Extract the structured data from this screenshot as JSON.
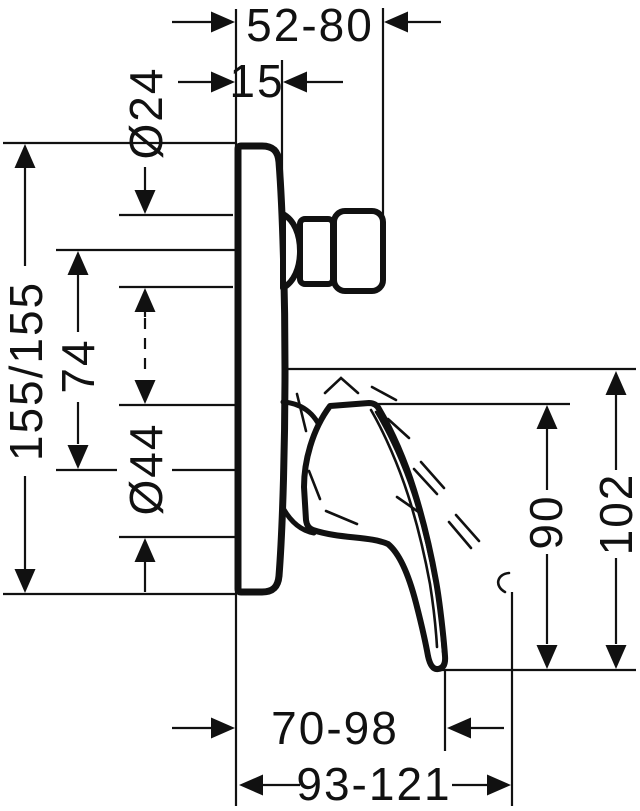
{
  "diagram": {
    "kind": "technical-dimension-drawing",
    "dimensions": {
      "knob_projection_range": "52-80",
      "plate_thickness": "15",
      "knob_diameter": "Ø24",
      "plate_height": "155/155",
      "knob_to_lever_distance": "74",
      "lever_hub_diameter": "Ø44",
      "lever_length": "90",
      "lever_overall_length": "102",
      "lever_tip_projection_range": "70-98",
      "lever_max_projection_range": "93-121"
    },
    "colors": {
      "line": "#111111",
      "background": "#ffffff"
    }
  }
}
